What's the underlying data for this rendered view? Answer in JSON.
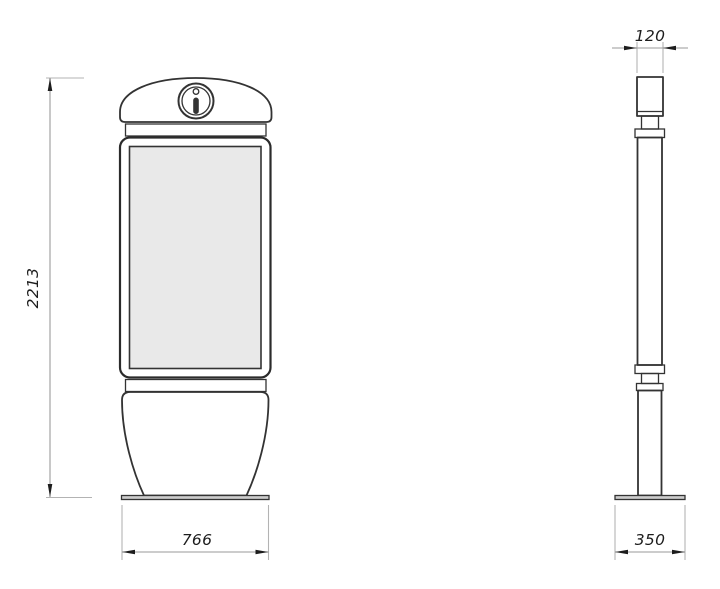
{
  "colors": {
    "background": "#ffffff",
    "outline": "#333333",
    "outline-strong": "#2b2b2b",
    "screen-fill": "#e9e9e9",
    "plate-fill": "#cccccc",
    "ext-line": "#b3b3b3",
    "dim-line": "#9a9a9a",
    "dim-text": "#1d1d1d"
  },
  "dimensions": {
    "overall_height": "2213",
    "base_width": "766",
    "top_depth": "120",
    "base_depth": "350"
  },
  "icon": {
    "name": "info-icon"
  }
}
